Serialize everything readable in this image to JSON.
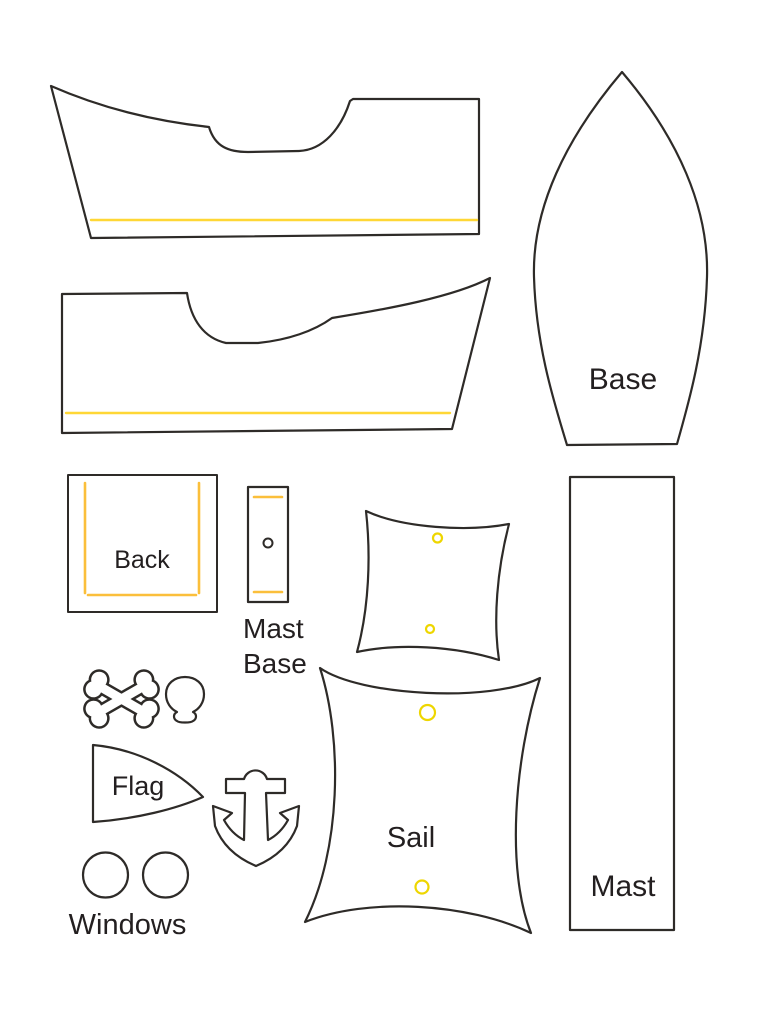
{
  "page": {
    "background": "#ffffff"
  },
  "colors": {
    "outline": "#2e2b28",
    "label": "#231f20",
    "gold": "#fbbf3b",
    "yellow": "#ffd735",
    "hole": "#eed600"
  },
  "labels": {
    "base": "Base",
    "back": "Back",
    "mast_base_line1": "Mast",
    "mast_base_line2": "Base",
    "flag": "Flag",
    "sail": "Sail",
    "windows": "Windows",
    "mast": "Mast"
  }
}
